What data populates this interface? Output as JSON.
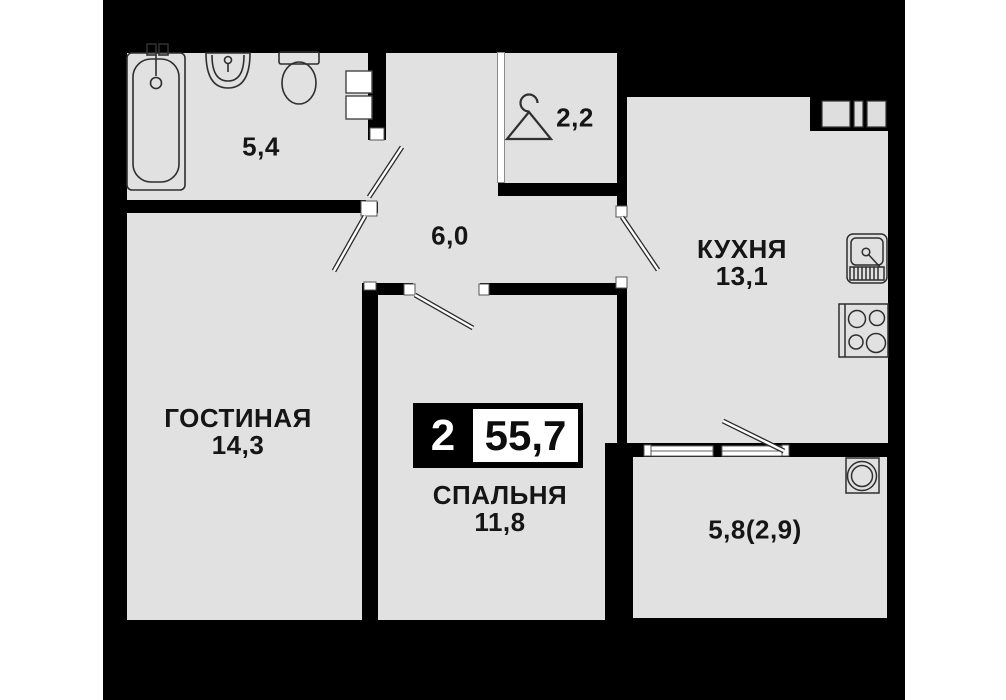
{
  "plan": {
    "type": "apartment-floor-plan",
    "badge": {
      "room_count": "2",
      "total_area": "55,7"
    },
    "rooms": {
      "bathroom": {
        "area": "5,4"
      },
      "wardrobe": {
        "area": "2,2"
      },
      "hallway": {
        "area": "6,0"
      },
      "kitchen": {
        "name": "КУХНЯ",
        "area": "13,1"
      },
      "living_room": {
        "name": "ГОСТИНАЯ",
        "area": "14,3"
      },
      "bedroom": {
        "name": "СПАЛЬНЯ",
        "area": "11,8"
      },
      "balcony": {
        "area": "5,8(2,9)"
      }
    },
    "icons": [
      "bathtub-icon",
      "bath-sink-icon",
      "toilet-icon",
      "hanger-icon",
      "kitchen-sink-icon",
      "stove-icon",
      "water-heater-icon",
      "vent-shaft-icon",
      "window-icon",
      "door-leaf-icon"
    ],
    "colors": {
      "background": "#000000",
      "floor": "#e1e1e1",
      "wall": "#000000",
      "fixture_outline": "#2f2f2f",
      "text": "#151515",
      "badge_background": "#000000",
      "badge_inner_box": "#ffffff"
    }
  }
}
